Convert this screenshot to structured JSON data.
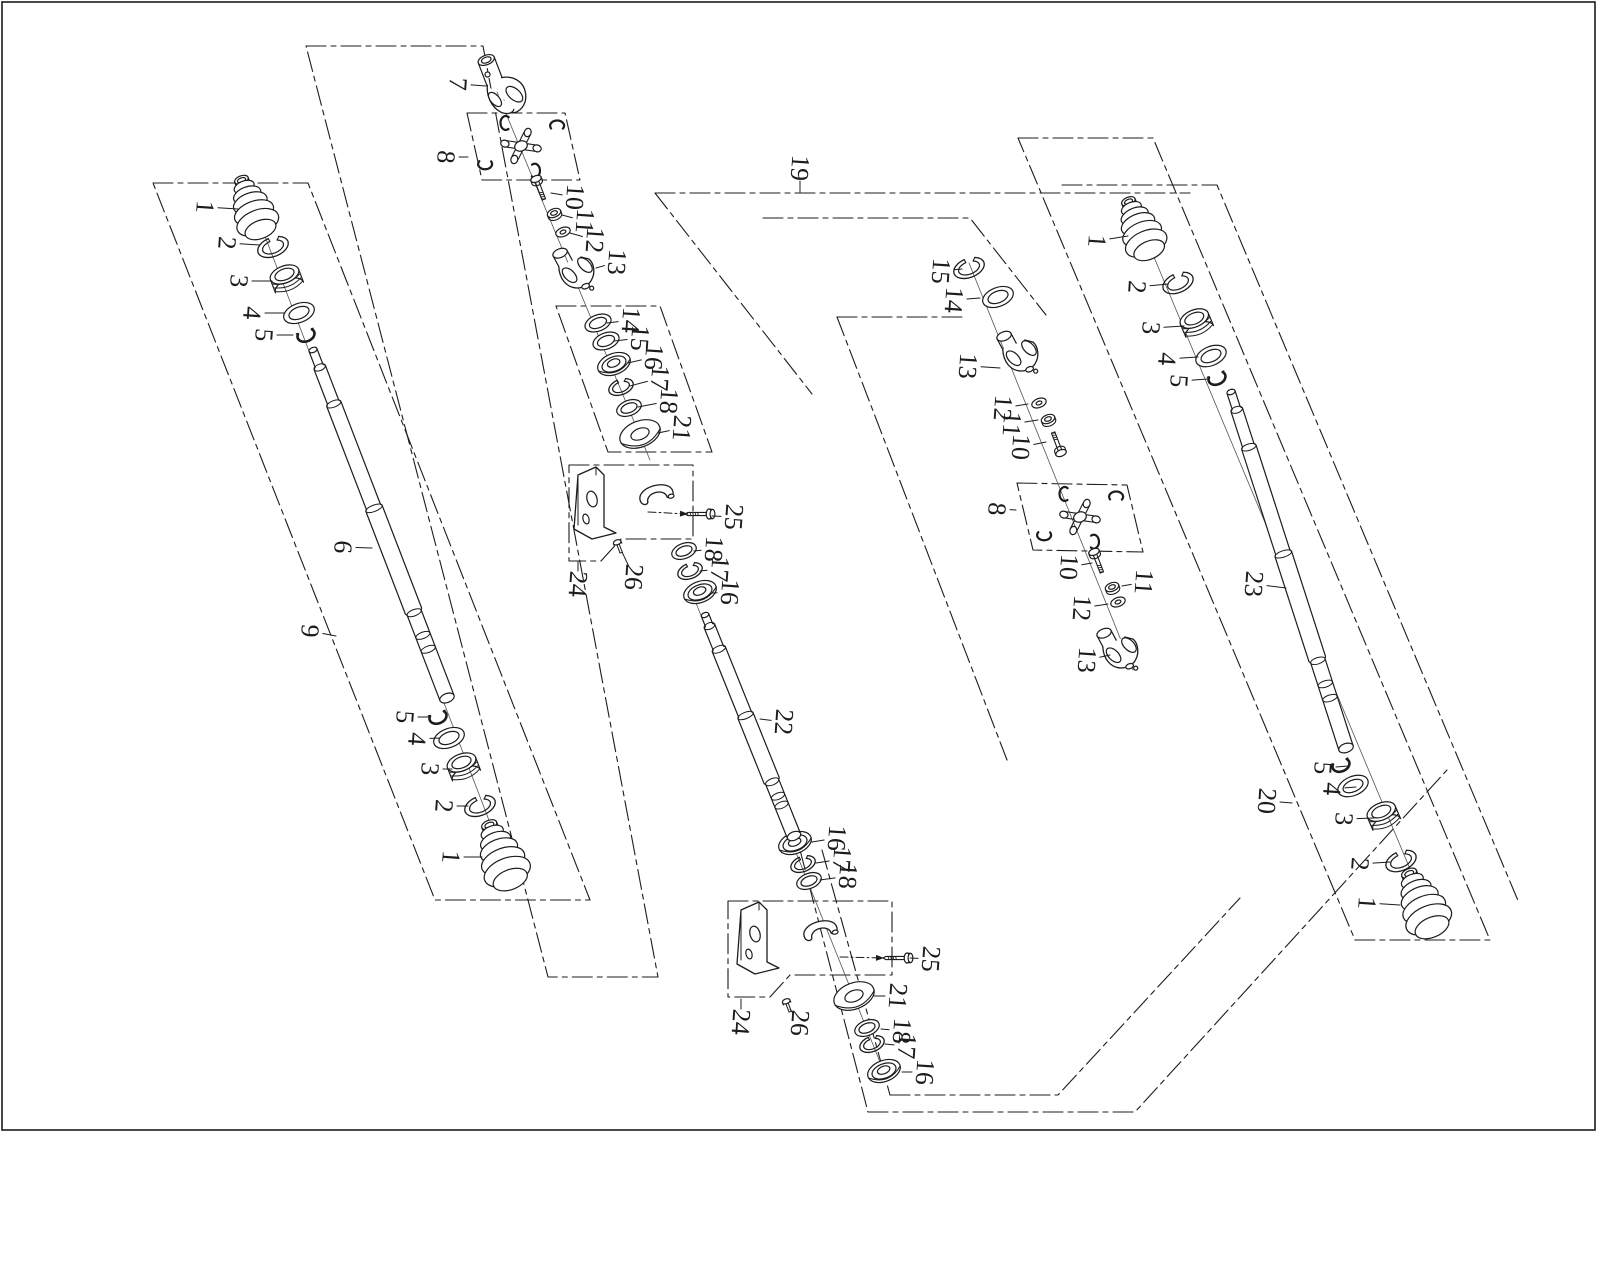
{
  "title": "drive-shaft-exploded-parts-diagram",
  "canvas": {
    "w": 1600,
    "h": 1280
  },
  "frame": {
    "x": 2,
    "y": 2,
    "w": 1593,
    "h": 1128
  },
  "style": {
    "ink": "#1c1c1c",
    "bg": "#ffffff",
    "boundary_dash": "20 5 5 5",
    "label_font_size": 26,
    "label_rotation": 94
  },
  "boundaries": [
    {
      "name": "group-9-outline",
      "closed": true,
      "pts": [
        [
          153,
          183
        ],
        [
          308,
          183
        ],
        [
          590,
          900
        ],
        [
          435,
          900
        ]
      ]
    },
    {
      "name": "group-band-outline",
      "closed": true,
      "pts": [
        [
          306,
          46
        ],
        [
          483,
          46
        ],
        [
          658,
          977
        ],
        [
          548,
          977
        ]
      ]
    },
    {
      "name": "joint-box-8-left",
      "closed": true,
      "pts": [
        [
          467,
          113
        ],
        [
          565,
          113
        ],
        [
          580,
          180
        ],
        [
          482,
          180
        ]
      ]
    },
    {
      "name": "subgroup-14-21",
      "closed": true,
      "pts": [
        [
          556,
          306
        ],
        [
          660,
          306
        ],
        [
          712,
          452
        ],
        [
          608,
          452
        ]
      ]
    },
    {
      "name": "bracket-box-24-upper",
      "closed": true,
      "pts": [
        [
          569,
          465
        ],
        [
          693,
          465
        ],
        [
          693,
          539
        ],
        [
          621,
          539
        ],
        [
          601,
          561
        ],
        [
          569,
          561
        ]
      ]
    },
    {
      "name": "bracket-box-24-lower",
      "closed": true,
      "pts": [
        [
          728,
          901
        ],
        [
          892,
          901
        ],
        [
          892,
          975
        ],
        [
          790,
          975
        ],
        [
          770,
          997
        ],
        [
          728,
          997
        ]
      ]
    },
    {
      "name": "group-20-outline",
      "closed": true,
      "pts": [
        [
          1018,
          138
        ],
        [
          1153,
          138
        ],
        [
          1490,
          940
        ],
        [
          1355,
          940
        ]
      ]
    },
    {
      "name": "joint-box-8-right",
      "closed": true,
      "pts": [
        [
          1017,
          483
        ],
        [
          1127,
          485
        ],
        [
          1143,
          552
        ],
        [
          1033,
          550
        ]
      ]
    },
    {
      "name": "group-19-top-edge",
      "closed": false,
      "pts": [
        [
          655,
          193
        ],
        [
          1190,
          193
        ]
      ]
    },
    {
      "name": "group-19-left-step-a",
      "closed": false,
      "pts": [
        [
          655,
          193
        ],
        [
          812,
          394
        ]
      ]
    },
    {
      "name": "group-19-step-b",
      "closed": false,
      "pts": [
        [
          763,
          218
        ],
        [
          970,
          218
        ],
        [
          1046,
          315
        ]
      ]
    },
    {
      "name": "group-19-step-c",
      "closed": false,
      "pts": [
        [
          837,
          317
        ],
        [
          967,
          317
        ]
      ]
    },
    {
      "name": "group-19-long-diagonal",
      "closed": false,
      "pts": [
        [
          837,
          317
        ],
        [
          1007,
          760
        ]
      ]
    },
    {
      "name": "group-19-bottom-step-inner",
      "closed": false,
      "pts": [
        [
          890,
          1095
        ],
        [
          1058,
          1095
        ],
        [
          1240,
          898
        ]
      ]
    },
    {
      "name": "group-19-bottom-step-outer",
      "closed": false,
      "pts": [
        [
          868,
          1112
        ],
        [
          1135,
          1112
        ],
        [
          1447,
          770
        ]
      ]
    },
    {
      "name": "group-19-bottom-left-a",
      "closed": false,
      "pts": [
        [
          800,
          850
        ],
        [
          868,
          1112
        ]
      ]
    },
    {
      "name": "group-19-bottom-left-b",
      "closed": false,
      "pts": [
        [
          822,
          850
        ],
        [
          890,
          1095
        ]
      ]
    },
    {
      "name": "group-19-right-step",
      "closed": false,
      "pts": [
        [
          1062,
          185
        ],
        [
          1217,
          185
        ],
        [
          1519,
          903
        ]
      ]
    }
  ],
  "axes": [
    [
      253,
      205,
      505,
      862
    ],
    [
      497,
      92,
      650,
      460
    ],
    [
      690,
      588,
      884,
      1072
    ],
    [
      969,
      263,
      1133,
      670
    ],
    [
      1141,
      226,
      1428,
      912
    ]
  ],
  "arrows": [
    {
      "name": "bolt-25-upper-leader",
      "pts": [
        [
          648,
          512
        ],
        [
          688,
          514
        ]
      ]
    },
    {
      "name": "bolt-25-lower-leader",
      "pts": [
        [
          840,
          957
        ],
        [
          884,
          958
        ]
      ]
    }
  ],
  "parts": [
    {
      "t": "boot",
      "x": 253,
      "y": 210,
      "s": 0.95,
      "r": -21
    },
    {
      "t": "oring",
      "x": 273,
      "y": 247,
      "s": 1,
      "r": -21
    },
    {
      "t": "collar",
      "x": 287,
      "y": 281,
      "s": 1,
      "r": -21
    },
    {
      "t": "ring",
      "x": 299,
      "y": 313,
      "s": 1,
      "r": -21
    },
    {
      "t": "clip",
      "x": 306,
      "y": 335,
      "s": 0.8,
      "r": -21
    },
    {
      "t": "shaft",
      "from": [
        313,
        350
      ],
      "to": [
        447,
        698
      ],
      "w": 15
    },
    {
      "t": "clip",
      "x": 438,
      "y": 717,
      "s": 0.8,
      "r": -21
    },
    {
      "t": "ring",
      "x": 449,
      "y": 738,
      "s": 1,
      "r": -21
    },
    {
      "t": "collar",
      "x": 464,
      "y": 769,
      "s": 1,
      "r": -21
    },
    {
      "t": "oring",
      "x": 480,
      "y": 806,
      "s": 1,
      "r": -21
    },
    {
      "t": "boot",
      "x": 502,
      "y": 858,
      "s": 1.05,
      "r": -21
    },
    {
      "t": "yokeA",
      "x": 497,
      "y": 88,
      "s": 1,
      "r": -21
    },
    {
      "t": "ujoint",
      "x": 521,
      "y": 146,
      "s": 1,
      "r": -21
    },
    {
      "t": "bolt",
      "x": 541,
      "y": 192,
      "s": 1,
      "r": -21
    },
    {
      "t": "nut",
      "x": 554,
      "y": 213,
      "s": 1,
      "r": -21
    },
    {
      "t": "washer",
      "x": 563,
      "y": 232,
      "s": 1,
      "r": -21
    },
    {
      "t": "yokeB",
      "x": 578,
      "y": 272,
      "s": 1,
      "r": -21
    },
    {
      "t": "ring",
      "x": 598,
      "y": 323,
      "s": 0.85,
      "r": -21
    },
    {
      "t": "ring",
      "x": 606,
      "y": 341,
      "s": 0.85,
      "r": -21
    },
    {
      "t": "bear",
      "x": 614,
      "y": 364,
      "s": 1,
      "r": -21
    },
    {
      "t": "oring",
      "x": 621,
      "y": 387,
      "s": 0.8,
      "r": -21
    },
    {
      "t": "ring",
      "x": 629,
      "y": 408,
      "s": 0.8,
      "r": -21
    },
    {
      "t": "torus",
      "x": 640,
      "y": 434,
      "s": 1,
      "r": -21
    },
    {
      "t": "bracket",
      "x": 602,
      "y": 505,
      "s": 1,
      "r": 0
    },
    {
      "t": "cap",
      "x": 656,
      "y": 494,
      "s": 1,
      "r": -15
    },
    {
      "t": "bolth",
      "x": 700,
      "y": 514,
      "s": 1,
      "r": 0
    },
    {
      "t": "screw",
      "x": 619,
      "y": 547,
      "s": 1,
      "r": -21
    },
    {
      "t": "ring",
      "x": 684,
      "y": 551,
      "s": 0.8,
      "r": -21
    },
    {
      "t": "oring",
      "x": 690,
      "y": 571,
      "s": 0.8,
      "r": -21
    },
    {
      "t": "bear",
      "x": 700,
      "y": 592,
      "s": 1,
      "r": -21
    },
    {
      "t": "shaft",
      "from": [
        705,
        615
      ],
      "to": [
        794,
        836
      ],
      "w": 14
    },
    {
      "t": "bear",
      "x": 795,
      "y": 843,
      "s": 1,
      "r": -21
    },
    {
      "t": "oring",
      "x": 803,
      "y": 864,
      "s": 0.8,
      "r": -21
    },
    {
      "t": "ring",
      "x": 809,
      "y": 881,
      "s": 0.8,
      "r": -21
    },
    {
      "t": "bracket",
      "x": 765,
      "y": 940,
      "s": 1,
      "r": 0
    },
    {
      "t": "cap",
      "x": 820,
      "y": 930,
      "s": 1,
      "r": -15
    },
    {
      "t": "bolth",
      "x": 898,
      "y": 958,
      "s": 1,
      "r": 0
    },
    {
      "t": "screw",
      "x": 788,
      "y": 1006,
      "s": 1,
      "r": -21
    },
    {
      "t": "torus",
      "x": 854,
      "y": 996,
      "s": 1,
      "r": -21
    },
    {
      "t": "ring",
      "x": 867,
      "y": 1028,
      "s": 0.8,
      "r": -21
    },
    {
      "t": "oring",
      "x": 872,
      "y": 1044,
      "s": 0.8,
      "r": -21
    },
    {
      "t": "bear",
      "x": 884,
      "y": 1071,
      "s": 1,
      "r": -21
    },
    {
      "t": "oring",
      "x": 969,
      "y": 268,
      "s": 1,
      "r": -21
    },
    {
      "t": "ring",
      "x": 998,
      "y": 297,
      "s": 1,
      "r": -21
    },
    {
      "t": "yokeB",
      "x": 1022,
      "y": 355,
      "s": 1,
      "r": -21
    },
    {
      "t": "washer",
      "x": 1039,
      "y": 403,
      "s": 1,
      "r": -21
    },
    {
      "t": "nut",
      "x": 1048,
      "y": 419,
      "s": 1,
      "r": -21
    },
    {
      "t": "bolt",
      "x": 1056,
      "y": 440,
      "s": 1,
      "r": 159
    },
    {
      "t": "ujoint",
      "x": 1080,
      "y": 517,
      "s": 1,
      "r": -21
    },
    {
      "t": "bolt",
      "x": 1099,
      "y": 565,
      "s": 1,
      "r": -21
    },
    {
      "t": "nut",
      "x": 1112,
      "y": 587,
      "s": 1,
      "r": -21
    },
    {
      "t": "washer",
      "x": 1118,
      "y": 602,
      "s": 1,
      "r": -21
    },
    {
      "t": "yokeB",
      "x": 1122,
      "y": 652,
      "s": 1,
      "r": -21
    },
    {
      "t": "shaft",
      "from": [
        1231,
        392
      ],
      "to": [
        1346,
        748
      ],
      "w": 15
    },
    {
      "t": "boot",
      "x": 1141,
      "y": 231,
      "s": 0.95,
      "r": -23
    },
    {
      "t": "oring",
      "x": 1178,
      "y": 283,
      "s": 1,
      "r": -23
    },
    {
      "t": "collar",
      "x": 1197,
      "y": 325,
      "s": 1,
      "r": -23
    },
    {
      "t": "ring",
      "x": 1211,
      "y": 356,
      "s": 1,
      "r": -23
    },
    {
      "t": "clip",
      "x": 1217,
      "y": 378,
      "s": 0.8,
      "r": -23
    },
    {
      "t": "clip",
      "x": 1341,
      "y": 765,
      "s": 0.8,
      "r": -23
    },
    {
      "t": "ring",
      "x": 1353,
      "y": 786,
      "s": 1,
      "r": -23
    },
    {
      "t": "collar",
      "x": 1384,
      "y": 818,
      "s": 1,
      "r": -23
    },
    {
      "t": "oring",
      "x": 1401,
      "y": 861,
      "s": 1,
      "r": -23
    },
    {
      "t": "boot",
      "x": 1423,
      "y": 906,
      "s": 1.05,
      "r": -23
    }
  ],
  "callouts": [
    {
      "n": "1",
      "x": 205,
      "y": 207,
      "tx": 238,
      "ty": 209
    },
    {
      "n": "2",
      "x": 227,
      "y": 243,
      "tx": 260,
      "ty": 245
    },
    {
      "n": "3",
      "x": 239,
      "y": 281,
      "tx": 272,
      "ty": 281
    },
    {
      "n": "4",
      "x": 252,
      "y": 313,
      "tx": 285,
      "ty": 313
    },
    {
      "n": "5",
      "x": 264,
      "y": 335,
      "tx": 293,
      "ty": 335
    },
    {
      "n": "6",
      "x": 343,
      "y": 547,
      "tx": 372,
      "ty": 548
    },
    {
      "n": "9",
      "x": 310,
      "y": 631,
      "tx": 336,
      "ty": 636
    },
    {
      "n": "5",
      "x": 405,
      "y": 717,
      "tx": 428,
      "ty": 717
    },
    {
      "n": "4",
      "x": 417,
      "y": 739,
      "tx": 440,
      "ty": 738
    },
    {
      "n": "3",
      "x": 430,
      "y": 769,
      "tx": 452,
      "ty": 769
    },
    {
      "n": "2",
      "x": 444,
      "y": 806,
      "tx": 468,
      "ty": 806
    },
    {
      "n": "1",
      "x": 451,
      "y": 857,
      "tx": 482,
      "ty": 857
    },
    {
      "n": "7",
      "x": 458,
      "y": 84,
      "tx": 486,
      "ty": 86
    },
    {
      "n": "8",
      "x": 446,
      "y": 157,
      "tx": 468,
      "ty": 157
    },
    {
      "n": "10",
      "x": 575,
      "y": 197,
      "tx": 551,
      "ty": 193
    },
    {
      "n": "11",
      "x": 585,
      "y": 221,
      "tx": 562,
      "ty": 215
    },
    {
      "n": "12",
      "x": 595,
      "y": 240,
      "tx": 570,
      "ty": 233
    },
    {
      "n": "13",
      "x": 617,
      "y": 262,
      "tx": 596,
      "ty": 268
    },
    {
      "n": "14",
      "x": 631,
      "y": 320,
      "tx": 607,
      "ty": 323
    },
    {
      "n": "15",
      "x": 640,
      "y": 338,
      "tx": 614,
      "ty": 341
    },
    {
      "n": "16",
      "x": 654,
      "y": 357,
      "tx": 628,
      "ty": 363
    },
    {
      "n": "17",
      "x": 660,
      "y": 378,
      "tx": 630,
      "ty": 386
    },
    {
      "n": "18",
      "x": 669,
      "y": 401,
      "tx": 638,
      "ty": 407
    },
    {
      "n": "21",
      "x": 682,
      "y": 428,
      "tx": 658,
      "ty": 433
    },
    {
      "n": "25",
      "x": 734,
      "y": 517,
      "tx": 712,
      "ty": 516
    },
    {
      "n": "24",
      "x": 578,
      "y": 584,
      "tx": 578,
      "ty": 562
    },
    {
      "n": "26",
      "x": 634,
      "y": 577,
      "tx": 622,
      "ty": 552
    },
    {
      "n": "18",
      "x": 714,
      "y": 549,
      "tx": 694,
      "ty": 551
    },
    {
      "n": "17",
      "x": 720,
      "y": 569,
      "tx": 700,
      "ty": 571
    },
    {
      "n": "16",
      "x": 730,
      "y": 592,
      "tx": 712,
      "ty": 593
    },
    {
      "n": "22",
      "x": 784,
      "y": 722,
      "tx": 760,
      "ty": 719
    },
    {
      "n": "16",
      "x": 837,
      "y": 838,
      "tx": 812,
      "ty": 842
    },
    {
      "n": "17",
      "x": 842,
      "y": 859,
      "tx": 816,
      "ty": 863
    },
    {
      "n": "18",
      "x": 848,
      "y": 876,
      "tx": 820,
      "ty": 880
    },
    {
      "n": "25",
      "x": 931,
      "y": 959,
      "tx": 910,
      "ty": 958
    },
    {
      "n": "24",
      "x": 741,
      "y": 1022,
      "tx": 741,
      "ty": 999
    },
    {
      "n": "26",
      "x": 800,
      "y": 1023,
      "tx": 790,
      "ty": 1009
    },
    {
      "n": "21",
      "x": 898,
      "y": 996,
      "tx": 874,
      "ty": 996
    },
    {
      "n": "18",
      "x": 902,
      "y": 1031,
      "tx": 881,
      "ty": 1029
    },
    {
      "n": "17",
      "x": 907,
      "y": 1046,
      "tx": 885,
      "ty": 1044
    },
    {
      "n": "16",
      "x": 925,
      "y": 1072,
      "tx": 902,
      "ty": 1072
    },
    {
      "n": "19",
      "x": 800,
      "y": 168,
      "tx": 800,
      "ty": 192
    },
    {
      "n": "15",
      "x": 941,
      "y": 271,
      "tx": 962,
      "ty": 269
    },
    {
      "n": "14",
      "x": 954,
      "y": 300,
      "tx": 980,
      "ty": 298
    },
    {
      "n": "13",
      "x": 968,
      "y": 366,
      "tx": 1000,
      "ty": 368
    },
    {
      "n": "12",
      "x": 1003,
      "y": 408,
      "tx": 1028,
      "ty": 404
    },
    {
      "n": "11",
      "x": 1012,
      "y": 424,
      "tx": 1038,
      "ty": 420
    },
    {
      "n": "10",
      "x": 1021,
      "y": 447,
      "tx": 1046,
      "ty": 442
    },
    {
      "n": "8",
      "x": 997,
      "y": 509,
      "tx": 1016,
      "ty": 510
    },
    {
      "n": "10",
      "x": 1069,
      "y": 567,
      "tx": 1092,
      "ty": 563
    },
    {
      "n": "11",
      "x": 1144,
      "y": 582,
      "tx": 1122,
      "ty": 586
    },
    {
      "n": "12",
      "x": 1082,
      "y": 608,
      "tx": 1108,
      "ty": 604
    },
    {
      "n": "13",
      "x": 1087,
      "y": 660,
      "tx": 1110,
      "ty": 655
    },
    {
      "n": "23",
      "x": 1254,
      "y": 584,
      "tx": 1286,
      "ty": 588
    },
    {
      "n": "20",
      "x": 1267,
      "y": 801,
      "tx": 1292,
      "ty": 803
    },
    {
      "n": "1",
      "x": 1097,
      "y": 241,
      "tx": 1128,
      "ty": 236
    },
    {
      "n": "2",
      "x": 1137,
      "y": 287,
      "tx": 1168,
      "ty": 284
    },
    {
      "n": "3",
      "x": 1151,
      "y": 328,
      "tx": 1184,
      "ty": 326
    },
    {
      "n": "4",
      "x": 1167,
      "y": 359,
      "tx": 1198,
      "ty": 357
    },
    {
      "n": "5",
      "x": 1179,
      "y": 381,
      "tx": 1208,
      "ty": 379
    },
    {
      "n": "5",
      "x": 1323,
      "y": 768,
      "tx": 1348,
      "ty": 766
    },
    {
      "n": "4",
      "x": 1332,
      "y": 789,
      "tx": 1356,
      "ty": 787
    },
    {
      "n": "3",
      "x": 1344,
      "y": 819,
      "tx": 1374,
      "ty": 818
    },
    {
      "n": "2",
      "x": 1360,
      "y": 864,
      "tx": 1390,
      "ty": 862
    },
    {
      "n": "1",
      "x": 1367,
      "y": 903,
      "tx": 1400,
      "ty": 905
    }
  ]
}
